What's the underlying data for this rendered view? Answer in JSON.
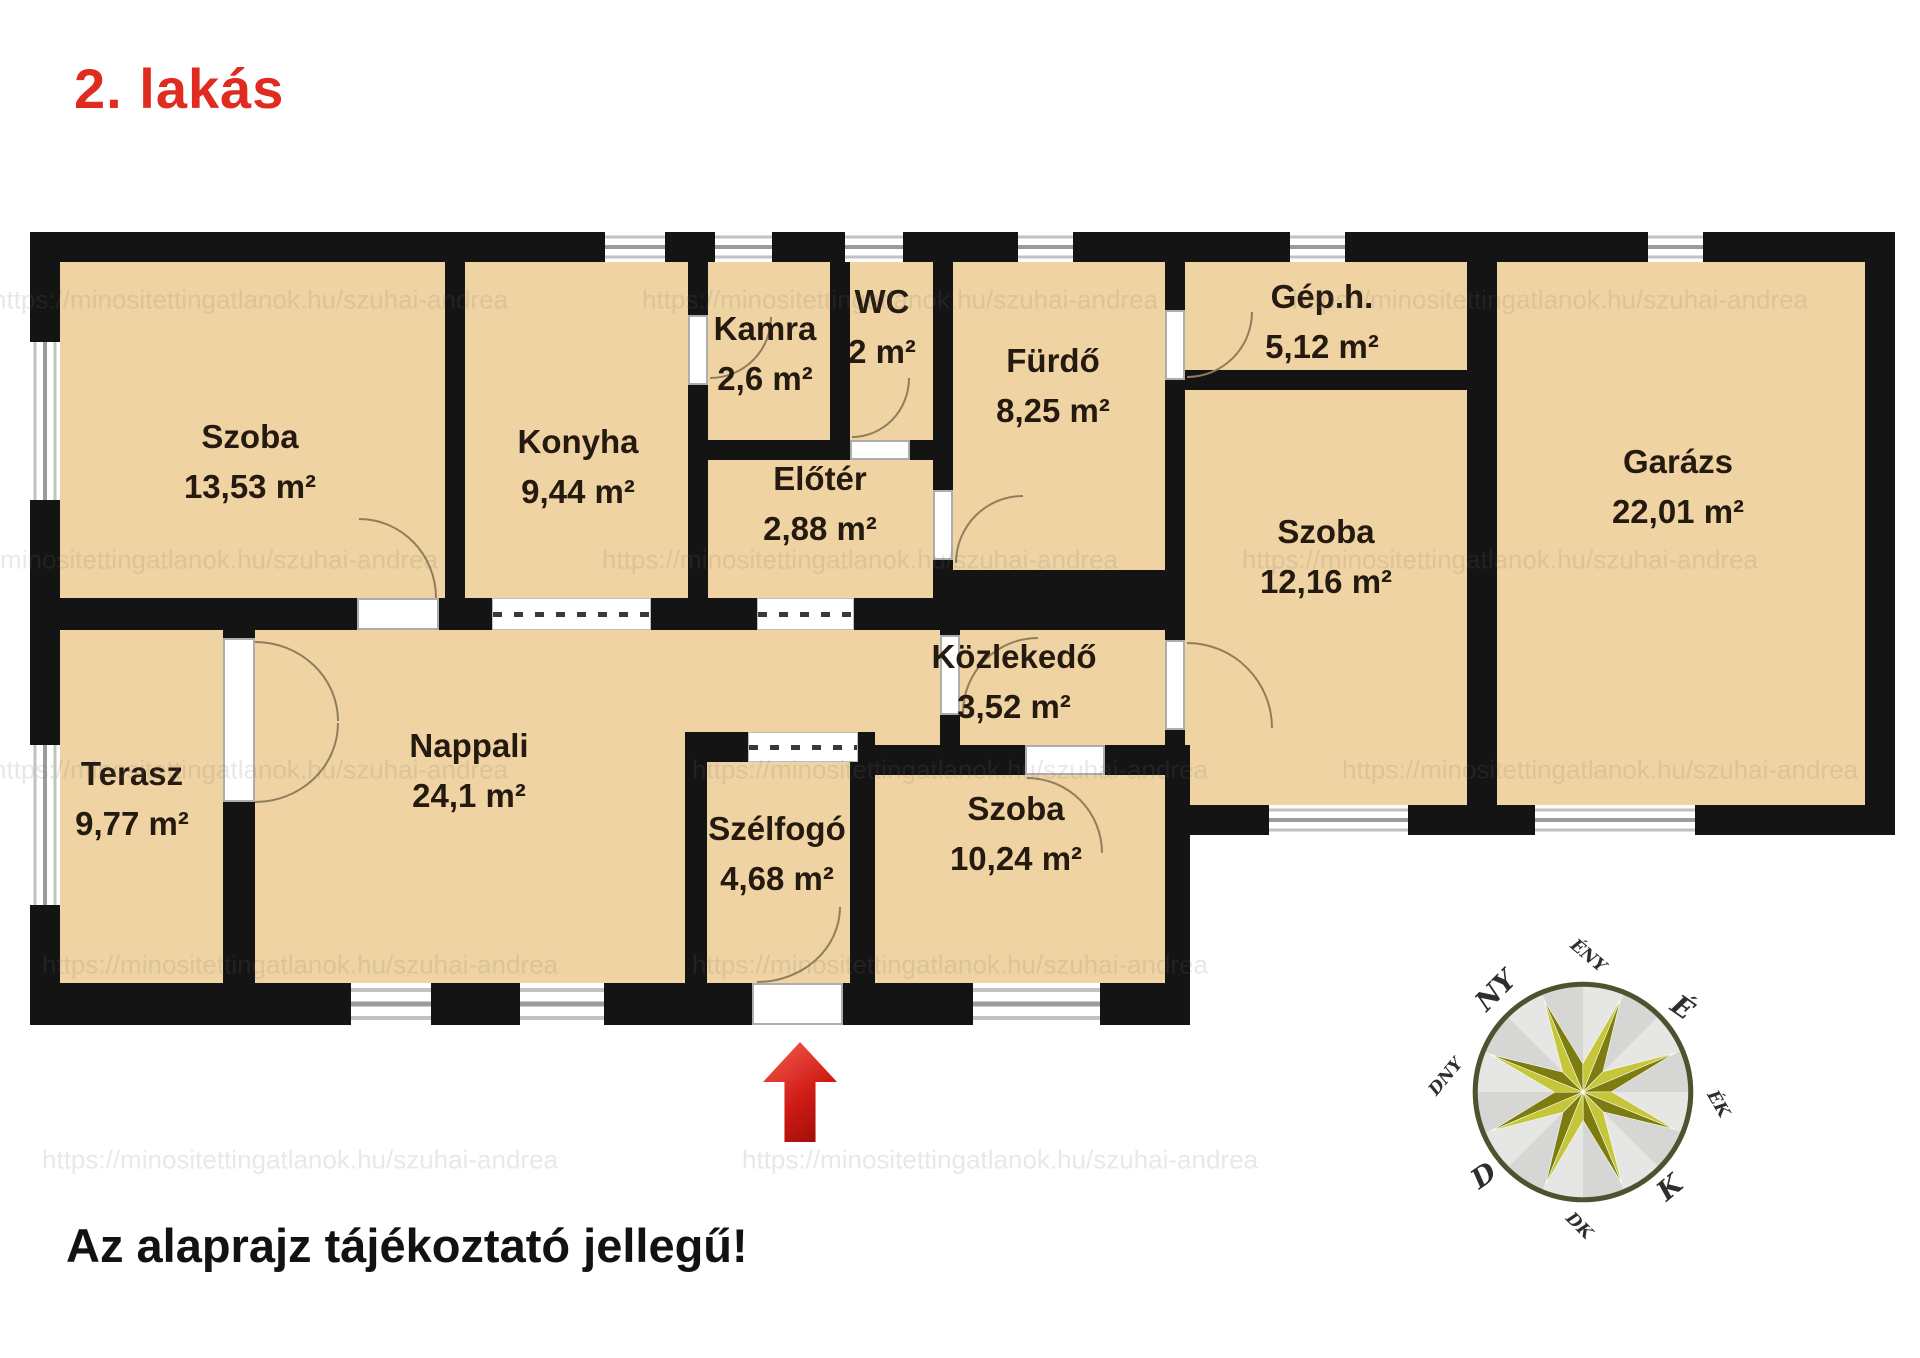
{
  "title": "2. lakás",
  "footer_note": "Az alaprajz tájékoztató jellegű!",
  "watermark": "https://minositettingatlanok.hu/szuhai-andrea",
  "colors": {
    "title_red": "#e02b20",
    "arrow_red": "#cf1b14",
    "room_fill": "#f0d3a3",
    "wall_black": "#141414",
    "label_dark": "#241a10",
    "compass_star_light": "#c6c63a",
    "compass_star_dark": "#7c7c10"
  },
  "plan": {
    "rooms": [
      {
        "id": "szoba-1",
        "name": "Szoba",
        "area": "13,53 m²",
        "cx": 250,
        "cy": 462
      },
      {
        "id": "konyha",
        "name": "Konyha",
        "area": "9,44 m²",
        "cx": 578,
        "cy": 467
      },
      {
        "id": "kamra",
        "name": "Kamra",
        "area": "2,6 m²",
        "cx": 765,
        "cy": 354
      },
      {
        "id": "wc",
        "name": "WC",
        "area": "2 m²",
        "cx": 882,
        "cy": 327
      },
      {
        "id": "eloter",
        "name": "Előtér",
        "area": "2,88 m²",
        "cx": 820,
        "cy": 504
      },
      {
        "id": "furdo",
        "name": "Fürdő",
        "area": "8,25 m²",
        "cx": 1053,
        "cy": 386
      },
      {
        "id": "gep-h",
        "name": "Gép.h.",
        "area": "5,12 m²",
        "cx": 1322,
        "cy": 322
      },
      {
        "id": "szoba-2",
        "name": "Szoba",
        "area": "12,16 m²",
        "cx": 1326,
        "cy": 557
      },
      {
        "id": "garazs",
        "name": "Garázs",
        "area": "22,01 m²",
        "cx": 1678,
        "cy": 487
      },
      {
        "id": "terasz",
        "name": "Terasz",
        "area": "9,77 m²",
        "cx": 132,
        "cy": 799
      },
      {
        "id": "nappali",
        "name": "Nappali",
        "area": "24,1 m²",
        "cx": 469,
        "cy": 771
      },
      {
        "id": "szelfogo",
        "name": "Szélfogó",
        "area": "4,68 m²",
        "cx": 777,
        "cy": 854
      },
      {
        "id": "szoba-3",
        "name": "Szoba",
        "area": "10,24 m²",
        "cx": 1016,
        "cy": 834
      },
      {
        "id": "kozlekedo",
        "name": "Közlekedő",
        "area": "3,52 m²",
        "cx": 1014,
        "cy": 682
      }
    ]
  },
  "compass": {
    "labels": [
      {
        "text": "É",
        "x": 1682,
        "y": 1008,
        "rot": 35,
        "major": true
      },
      {
        "text": "ÉK",
        "x": 1718,
        "y": 1104,
        "rot": 60,
        "major": false
      },
      {
        "text": "K",
        "x": 1670,
        "y": 1188,
        "rot": -40,
        "major": true
      },
      {
        "text": "DK",
        "x": 1579,
        "y": 1226,
        "rot": 45,
        "major": false
      },
      {
        "text": "D",
        "x": 1484,
        "y": 1176,
        "rot": -35,
        "major": true
      },
      {
        "text": "DNY",
        "x": 1446,
        "y": 1077,
        "rot": -50,
        "major": false
      },
      {
        "text": "NY",
        "x": 1496,
        "y": 991,
        "rot": -45,
        "major": true
      },
      {
        "text": "ÉNY",
        "x": 1588,
        "y": 956,
        "rot": 40,
        "major": false
      }
    ]
  }
}
